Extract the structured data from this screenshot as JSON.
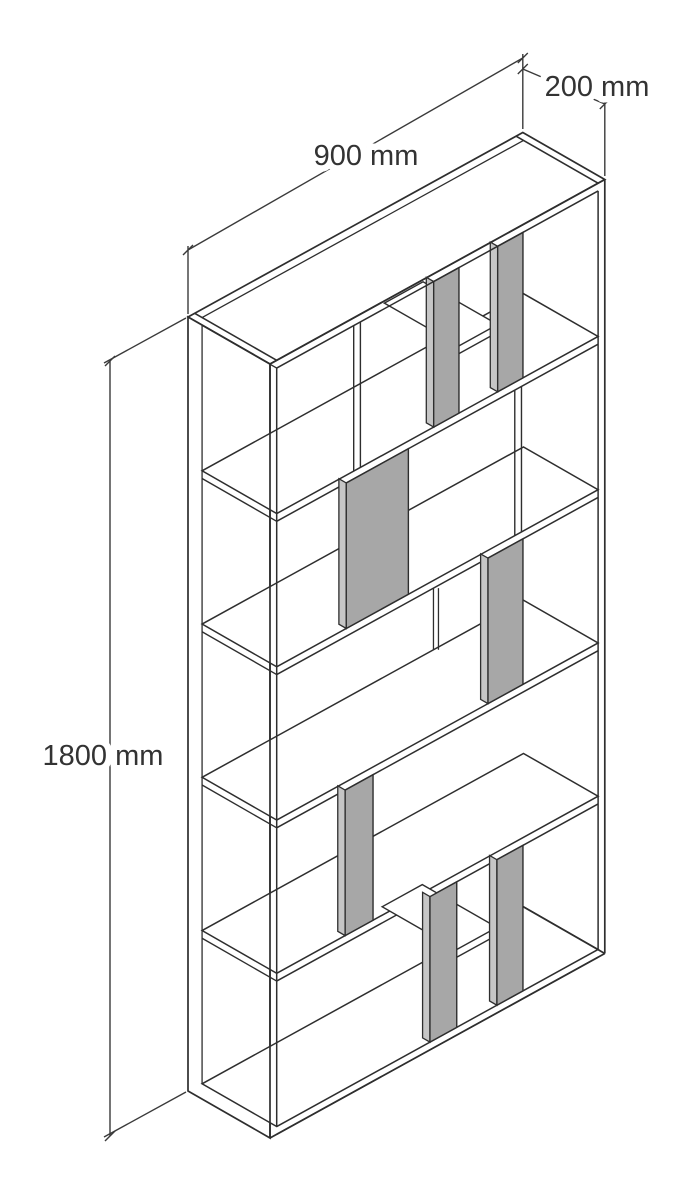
{
  "page": {
    "background": "#ffffff"
  },
  "diagram": {
    "type": "isometric-furniture-dimension-drawing",
    "object": "bookcase",
    "labels": {
      "width": "900 mm",
      "depth": "200 mm",
      "height": "1800 mm"
    },
    "dimensions_mm": {
      "width": 900,
      "depth": 200,
      "height": 1800
    },
    "colors": {
      "line": "#2e2e2e",
      "dim_line": "#3a3a3a",
      "panel_face": "#a7a7a7",
      "panel_edge": "#c6c6c6",
      "surface": "#ffffff",
      "text": "#333333",
      "halo": "#ffffff",
      "background": "#ffffff"
    },
    "font_px": 29,
    "label_positions": {
      "width": {
        "x": 366,
        "y": 156
      },
      "depth": {
        "x": 597,
        "y": 87
      },
      "height": {
        "x": 103,
        "y": 756
      }
    },
    "projection": {
      "origin": [
        188,
        317
      ],
      "w_per_mm": [
        0.372,
        -0.205
      ],
      "d_per_mm": [
        0.41,
        0.235
      ],
      "h_per_mm": [
        0,
        0.43
      ]
    },
    "structure": {
      "panel_thickness_mm": 18,
      "row_count": 5,
      "row_pitch_mm": 356.4,
      "opening_height_mm": 338.4,
      "shelf_levels_mm": [
        356.4,
        712.8,
        1069.2,
        1425.6,
        1782
      ],
      "row_tops_mm": [
        18,
        374.4,
        730.8,
        1087.2,
        1443.6
      ],
      "gray_panels": [
        {
          "row": 1,
          "from_mm": 440,
          "to_mm": 508
        },
        {
          "row": 1,
          "from_mm": 612,
          "to_mm": 680
        },
        {
          "row": 2,
          "from_mm": 205,
          "to_mm": 372
        },
        {
          "row": 3,
          "from_mm": 586,
          "to_mm": 680
        },
        {
          "row": 4,
          "from_mm": 202,
          "to_mm": 277
        },
        {
          "row": 5,
          "from_mm": 430,
          "to_mm": 502
        },
        {
          "row": 5,
          "from_mm": 610,
          "to_mm": 680
        }
      ],
      "front_dividers": [
        {
          "row": 1,
          "at_mm": 225
        },
        {
          "row": 2,
          "at_mm": 658
        }
      ],
      "back_seams": [
        {
          "row": 3,
          "at_mm": 640
        }
      ],
      "mini_shelves": [
        {
          "row": 1,
          "from_mm": 508,
          "to_mm": 612,
          "height_mm": 200
        },
        {
          "row": 5,
          "from_mm": 502,
          "to_mm": 610,
          "height_mm": 1601
        }
      ]
    },
    "dimension_lines": {
      "width": {
        "line": [
          [
            188,
            250
          ],
          [
            522.8,
            58
          ]
        ],
        "ext": [
          [
            [
              188,
              314
            ],
            [
              188,
              246
            ]
          ],
          [
            [
              522.8,
              129
            ],
            [
              522.8,
              54
            ]
          ]
        ]
      },
      "depth": {
        "line": [
          [
            522.8,
            69
          ],
          [
            604.8,
            104
          ]
        ],
        "ext": [
          [
            [
              604.8,
              176
            ],
            [
              604.8,
              100
            ]
          ]
        ]
      },
      "height": {
        "line": [
          [
            110,
            361
          ],
          [
            110,
            1136
          ]
        ],
        "ext": [
          [
            [
              186,
              318
            ],
            [
              104,
              363
            ]
          ],
          [
            [
              186,
              1092
            ],
            [
              104,
              1137
            ]
          ]
        ]
      }
    }
  }
}
